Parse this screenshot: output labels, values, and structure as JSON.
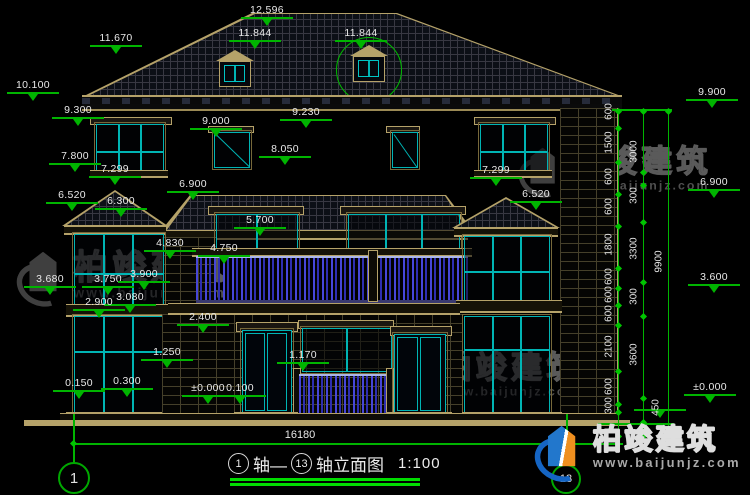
{
  "watermark": {
    "brand": "柏竣建筑",
    "url": "www.baijunjz.com"
  },
  "footer": {
    "overall_width": "16180",
    "axis_start": "1",
    "axis_end": "13",
    "t1": "轴—",
    "t2": "轴立面图",
    "scale": "1:100"
  },
  "axes": {
    "left": "1",
    "right": "13"
  },
  "levels": [
    {
      "t": "12.596",
      "x": 267,
      "y": 5
    },
    {
      "t": "11.670",
      "x": 116,
      "y": 33
    },
    {
      "t": "11.844",
      "x": 255,
      "y": 28
    },
    {
      "t": "11.844",
      "x": 361,
      "y": 28
    },
    {
      "t": "10.100",
      "x": 33,
      "y": 80
    },
    {
      "t": "9.300",
      "x": 78,
      "y": 105
    },
    {
      "t": "9.000",
      "x": 216,
      "y": 116
    },
    {
      "t": "9.230",
      "x": 306,
      "y": 107
    },
    {
      "t": "8.050",
      "x": 285,
      "y": 144
    },
    {
      "t": "7.800",
      "x": 75,
      "y": 151
    },
    {
      "t": "7.299",
      "x": 115,
      "y": 164
    },
    {
      "t": "7.299",
      "x": 496,
      "y": 165
    },
    {
      "t": "6.900",
      "x": 193,
      "y": 179
    },
    {
      "t": "6.900",
      "x": 714,
      "y": 177
    },
    {
      "t": "6.520",
      "x": 72,
      "y": 190
    },
    {
      "t": "6.520",
      "x": 536,
      "y": 189
    },
    {
      "t": "6.300",
      "x": 121,
      "y": 196
    },
    {
      "t": "5.700",
      "x": 260,
      "y": 215
    },
    {
      "t": "4.830",
      "x": 170,
      "y": 238
    },
    {
      "t": "4.750",
      "x": 224,
      "y": 243
    },
    {
      "t": "3.680",
      "x": 50,
      "y": 274
    },
    {
      "t": "3.750",
      "x": 108,
      "y": 274
    },
    {
      "t": "3.900",
      "x": 144,
      "y": 269
    },
    {
      "t": "3.080",
      "x": 130,
      "y": 292
    },
    {
      "t": "2.900",
      "x": 99,
      "y": 297
    },
    {
      "t": "2.400",
      "x": 203,
      "y": 312
    },
    {
      "t": "1.250",
      "x": 167,
      "y": 347
    },
    {
      "t": "1.170",
      "x": 303,
      "y": 350
    },
    {
      "t": "0.300",
      "x": 127,
      "y": 376
    },
    {
      "t": "0.150",
      "x": 79,
      "y": 378
    },
    {
      "t": "±0.000",
      "x": 208,
      "y": 383
    },
    {
      "t": "0.100",
      "x": 240,
      "y": 383
    },
    {
      "t": "9.900",
      "x": 712,
      "y": 87
    },
    {
      "t": "3.600",
      "x": 714,
      "y": 272
    },
    {
      "t": "±0.000",
      "x": 710,
      "y": 382
    },
    {
      "t": "",
      "x": 660,
      "y": 408
    }
  ],
  "vdims": [
    {
      "t": "600",
      "x": 609,
      "y": 112
    },
    {
      "t": "1500",
      "x": 609,
      "y": 143
    },
    {
      "t": "600",
      "x": 609,
      "y": 177
    },
    {
      "t": "600",
      "x": 609,
      "y": 207
    },
    {
      "t": "1800",
      "x": 609,
      "y": 245
    },
    {
      "t": "600",
      "x": 609,
      "y": 277
    },
    {
      "t": "600",
      "x": 609,
      "y": 295
    },
    {
      "t": "600",
      "x": 609,
      "y": 314
    },
    {
      "t": "2100",
      "x": 609,
      "y": 347
    },
    {
      "t": "600",
      "x": 609,
      "y": 387
    },
    {
      "t": "300",
      "x": 609,
      "y": 406
    },
    {
      "t": "3000",
      "x": 634,
      "y": 152
    },
    {
      "t": "300",
      "x": 634,
      "y": 196
    },
    {
      "t": "3300",
      "x": 634,
      "y": 249
    },
    {
      "t": "300",
      "x": 634,
      "y": 297
    },
    {
      "t": "3600",
      "x": 634,
      "y": 355
    },
    {
      "t": "450",
      "x": 656,
      "y": 408
    },
    {
      "t": "9900",
      "x": 659,
      "y": 262
    }
  ]
}
